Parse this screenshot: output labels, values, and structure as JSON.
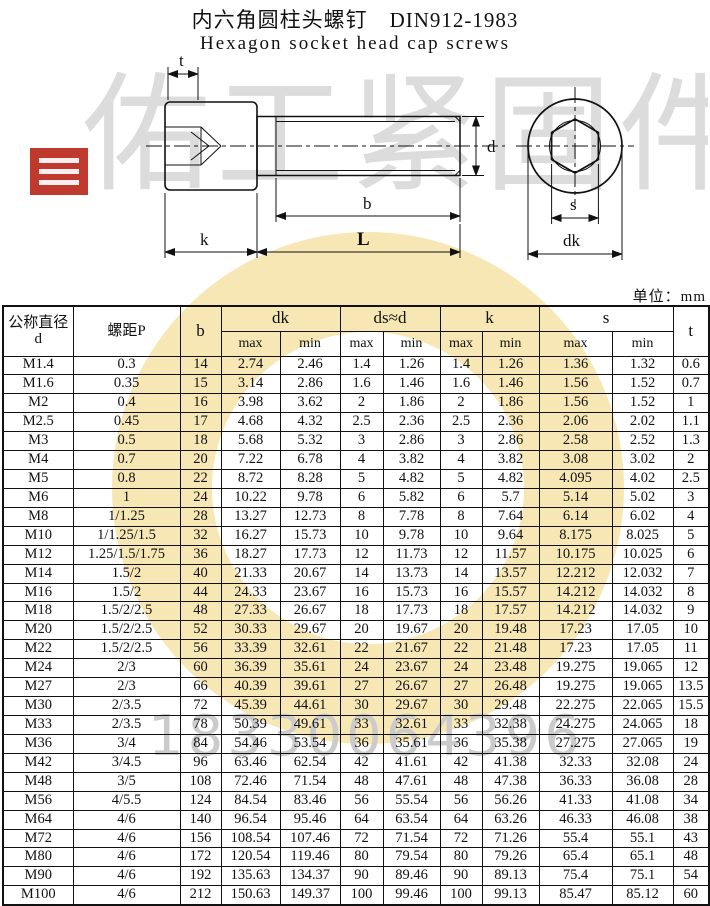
{
  "title": {
    "cn": "内六角圆柱头螺钉",
    "standard": "DIN912-1983",
    "en": "Hexagon socket head cap screws"
  },
  "unit_label": "单位：mm",
  "watermark": {
    "brand": "佑工紧固件",
    "phone": "18330064396",
    "seal_color": "#c0392f",
    "ring_color": "#f1d476",
    "brand_text_color": "#dcdcdc"
  },
  "diagram": {
    "labels": {
      "t": "t",
      "d": "d",
      "b": "b",
      "L": "L",
      "k": "k",
      "s": "s",
      "dk": "dk"
    }
  },
  "table": {
    "header": {
      "col_d": "公称直径",
      "col_d_sub": "d",
      "col_p": "螺距P",
      "col_b": "b",
      "col_dk": "dk",
      "col_ds": "ds≈d",
      "col_k": "k",
      "col_s": "s",
      "col_t": "t",
      "max": "max",
      "min": "min"
    },
    "rows": [
      [
        "M1.4",
        "0.3",
        "14",
        "2.74",
        "2.46",
        "1.4",
        "1.26",
        "1.4",
        "1.26",
        "1.36",
        "1.32",
        "0.6"
      ],
      [
        "M1.6",
        "0.35",
        "15",
        "3.14",
        "2.86",
        "1.6",
        "1.46",
        "1.6",
        "1.46",
        "1.56",
        "1.52",
        "0.7"
      ],
      [
        "M2",
        "0.4",
        "16",
        "3.98",
        "3.62",
        "2",
        "1.86",
        "2",
        "1.86",
        "1.56",
        "1.52",
        "1"
      ],
      [
        "M2.5",
        "0.45",
        "17",
        "4.68",
        "4.32",
        "2.5",
        "2.36",
        "2.5",
        "2.36",
        "2.06",
        "2.02",
        "1.1"
      ],
      [
        "M3",
        "0.5",
        "18",
        "5.68",
        "5.32",
        "3",
        "2.86",
        "3",
        "2.86",
        "2.58",
        "2.52",
        "1.3"
      ],
      [
        "M4",
        "0.7",
        "20",
        "7.22",
        "6.78",
        "4",
        "3.82",
        "4",
        "3.82",
        "3.08",
        "3.02",
        "2"
      ],
      [
        "M5",
        "0.8",
        "22",
        "8.72",
        "8.28",
        "5",
        "4.82",
        "5",
        "4.82",
        "4.095",
        "4.02",
        "2.5"
      ],
      [
        "M6",
        "1",
        "24",
        "10.22",
        "9.78",
        "6",
        "5.82",
        "6",
        "5.7",
        "5.14",
        "5.02",
        "3"
      ],
      [
        "M8",
        "1/1.25",
        "28",
        "13.27",
        "12.73",
        "8",
        "7.78",
        "8",
        "7.64",
        "6.14",
        "6.02",
        "4"
      ],
      [
        "M10",
        "1/1.25/1.5",
        "32",
        "16.27",
        "15.73",
        "10",
        "9.78",
        "10",
        "9.64",
        "8.175",
        "8.025",
        "5"
      ],
      [
        "M12",
        "1.25/1.5/1.75",
        "36",
        "18.27",
        "17.73",
        "12",
        "11.73",
        "12",
        "11.57",
        "10.175",
        "10.025",
        "6"
      ],
      [
        "M14",
        "1.5/2",
        "40",
        "21.33",
        "20.67",
        "14",
        "13.73",
        "14",
        "13.57",
        "12.212",
        "12.032",
        "7"
      ],
      [
        "M16",
        "1.5/2",
        "44",
        "24.33",
        "23.67",
        "16",
        "15.73",
        "16",
        "15.57",
        "14.212",
        "14.032",
        "8"
      ],
      [
        "M18",
        "1.5/2/2.5",
        "48",
        "27.33",
        "26.67",
        "18",
        "17.73",
        "18",
        "17.57",
        "14.212",
        "14.032",
        "9"
      ],
      [
        "M20",
        "1.5/2/2.5",
        "52",
        "30.33",
        "29.67",
        "20",
        "19.67",
        "20",
        "19.48",
        "17.23",
        "17.05",
        "10"
      ],
      [
        "M22",
        "1.5/2/2.5",
        "56",
        "33.39",
        "32.61",
        "22",
        "21.67",
        "22",
        "21.48",
        "17.23",
        "17.05",
        "11"
      ],
      [
        "M24",
        "2/3",
        "60",
        "36.39",
        "35.61",
        "24",
        "23.67",
        "24",
        "23.48",
        "19.275",
        "19.065",
        "12"
      ],
      [
        "M27",
        "2/3",
        "66",
        "40.39",
        "39.61",
        "27",
        "26.67",
        "27",
        "26.48",
        "19.275",
        "19.065",
        "13.5"
      ],
      [
        "M30",
        "2/3.5",
        "72",
        "45.39",
        "44.61",
        "30",
        "29.67",
        "30",
        "29.48",
        "22.275",
        "22.065",
        "15.5"
      ],
      [
        "M33",
        "2/3.5",
        "78",
        "50.39",
        "49.61",
        "33",
        "32.61",
        "33",
        "32.38",
        "24.275",
        "24.065",
        "18"
      ],
      [
        "M36",
        "3/4",
        "84",
        "54.46",
        "53.54",
        "36",
        "35.61",
        "36",
        "35.38",
        "27.275",
        "27.065",
        "19"
      ],
      [
        "M42",
        "3/4.5",
        "96",
        "63.46",
        "62.54",
        "42",
        "41.61",
        "42",
        "41.38",
        "32.33",
        "32.08",
        "24"
      ],
      [
        "M48",
        "3/5",
        "108",
        "72.46",
        "71.54",
        "48",
        "47.61",
        "48",
        "47.38",
        "36.33",
        "36.08",
        "28"
      ],
      [
        "M56",
        "4/5.5",
        "124",
        "84.54",
        "83.46",
        "56",
        "55.54",
        "56",
        "56.26",
        "41.33",
        "41.08",
        "34"
      ],
      [
        "M64",
        "4/6",
        "140",
        "96.54",
        "95.46",
        "64",
        "63.54",
        "64",
        "63.26",
        "46.33",
        "46.08",
        "38"
      ],
      [
        "M72",
        "4/6",
        "156",
        "108.54",
        "107.46",
        "72",
        "71.54",
        "72",
        "71.26",
        "55.4",
        "55.1",
        "43"
      ],
      [
        "M80",
        "4/6",
        "172",
        "120.54",
        "119.46",
        "80",
        "79.54",
        "80",
        "79.26",
        "65.4",
        "65.1",
        "48"
      ],
      [
        "M90",
        "4/6",
        "192",
        "135.63",
        "134.37",
        "90",
        "89.46",
        "90",
        "89.13",
        "75.4",
        "75.1",
        "54"
      ],
      [
        "M100",
        "4/6",
        "212",
        "150.63",
        "149.37",
        "100",
        "99.46",
        "100",
        "99.13",
        "85.47",
        "85.12",
        "60"
      ]
    ]
  }
}
